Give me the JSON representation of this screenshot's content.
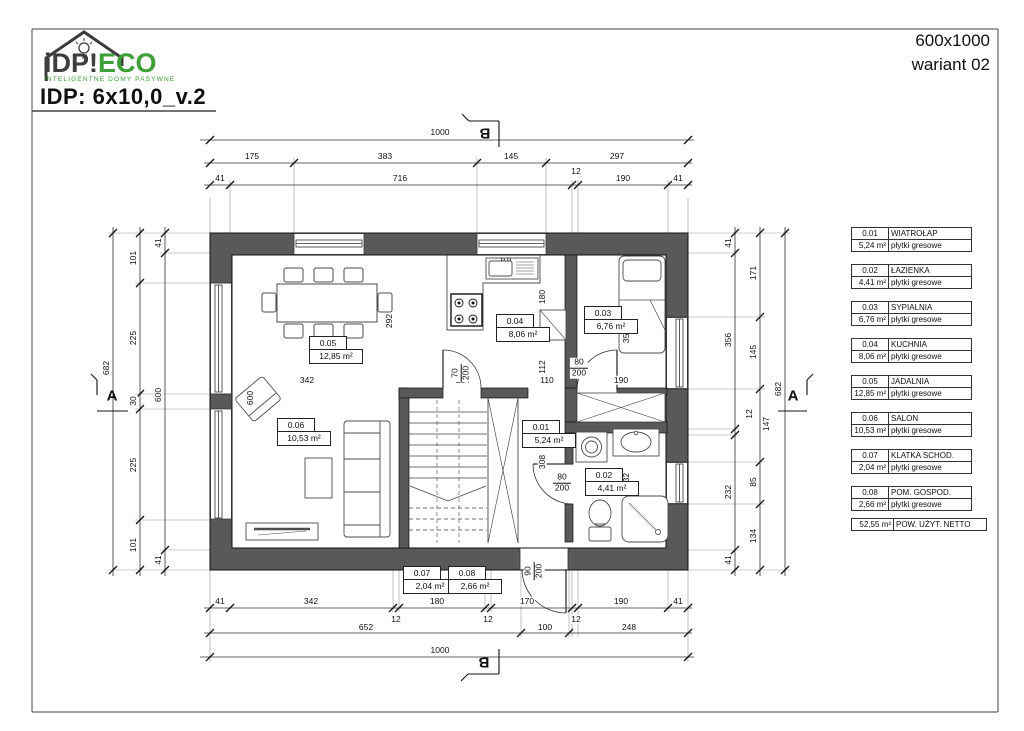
{
  "brand": {
    "part1": "iDP",
    "bang": "!",
    "part2": "ECO",
    "tagline": "INTELIGENTNE DOMY PASYWNE"
  },
  "title": "IDP: 6x10,0_v.2",
  "sheet": {
    "size": "600x1000",
    "variant": "wariant 02"
  },
  "sections": {
    "a": "A",
    "b": "B"
  },
  "legend": {
    "rooms": [
      {
        "no": "0.01",
        "name": "WIATROŁAP",
        "area": "5,24 m²",
        "floor": "płytki gresowe"
      },
      {
        "no": "0.02",
        "name": "ŁAZIENKA",
        "area": "4,41 m²",
        "floor": "płytki gresowe"
      },
      {
        "no": "0.03",
        "name": "SYPIALNIA",
        "area": "6,76 m²",
        "floor": "płytki gresowe"
      },
      {
        "no": "0.04",
        "name": "KUCHNIA",
        "area": "8,06 m²",
        "floor": "płytki gresowe"
      },
      {
        "no": "0.05",
        "name": "JADALNIA",
        "area": "12,85 m²",
        "floor": "płytki gresowe"
      },
      {
        "no": "0.06",
        "name": "SALON",
        "area": "10,53 m²",
        "floor": "płytki gresowe"
      },
      {
        "no": "0.07",
        "name": "KLATKA SCHOD.",
        "area": "2,04 m²",
        "floor": "płytki gresowe"
      },
      {
        "no": "0.08",
        "name": "POM. GOSPOD.",
        "area": "2,66 m²",
        "floor": "płytki gresowe"
      }
    ],
    "total": {
      "area": "52,55 m²",
      "label": "POW. UŻYT. NETTO"
    }
  },
  "dims": {
    "top": {
      "l1": [
        "1000"
      ],
      "l2": [
        "175",
        "383",
        "145",
        "297"
      ],
      "l3": [
        "41",
        "716",
        "12",
        "190",
        "41"
      ]
    },
    "bottom": {
      "l1": [
        "41",
        "342",
        "180",
        "170",
        "190",
        "41"
      ],
      "l1b": [
        "12",
        "12",
        "12"
      ],
      "l2": [
        "652",
        "100",
        "248"
      ],
      "l3": [
        "1000"
      ]
    },
    "left": {
      "l1": [
        "682"
      ],
      "l2": [
        "101",
        "225",
        "30",
        "225",
        "101"
      ],
      "l3": [
        "41",
        "600",
        "41"
      ]
    },
    "right": {
      "l1": [
        "41",
        "356",
        "12",
        "232",
        "41"
      ],
      "l2": [
        "171",
        "145",
        "147",
        "85",
        "134"
      ],
      "l3": [
        "682"
      ]
    },
    "inner": {
      "width": "600",
      "dining_h": "292",
      "kitchen_a": "180",
      "kitchen_b": "112",
      "hall_h": "308",
      "bedroom_h": "356",
      "bath_h": "232",
      "dining_w": "342",
      "stairs_w": "264",
      "hall_w": "110",
      "bedroom_w": "190"
    },
    "doors": {
      "stairs": {
        "w": "70",
        "h": "200"
      },
      "bedroom": {
        "w": "80",
        "h": "200"
      },
      "bath": {
        "w": "80",
        "h": "200"
      },
      "entry": {
        "w": "90",
        "h": "200"
      }
    }
  },
  "colors": {
    "wall": "#595959",
    "brand_green": "#3da036",
    "brand_dark": "#3d3d3d",
    "line": "#333333"
  }
}
